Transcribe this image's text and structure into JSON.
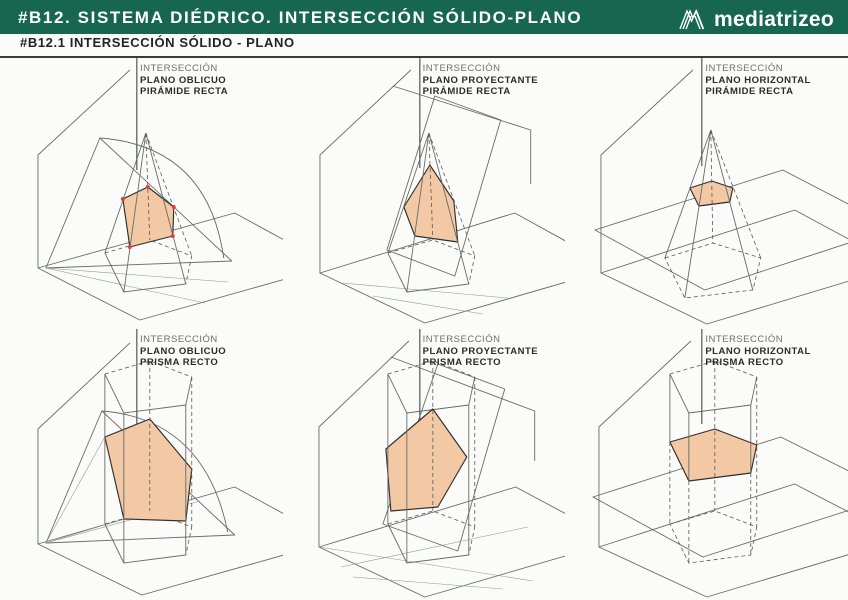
{
  "header": {
    "title": "#B12. SISTEMA DIÉDRICO. INTERSECCIÓN SÓLIDO-PLANO",
    "brand": "mediatrizeo"
  },
  "subheader": {
    "title": "#B12.1 INTERSECCIÓN SÓLIDO - PLANO"
  },
  "colors": {
    "header_green": "#17664f",
    "rule_dark": "#3a3a3a",
    "section_fill": "#f3c8a4",
    "section_outline": "#2f2f2f",
    "dot_red": "#e04040",
    "line_gray": "#676c68",
    "label_gray": "#6e6e6e",
    "label_dark": "#2b2b2b"
  },
  "panels": [
    {
      "id": "plano-oblicuo-piramide",
      "label_lines": [
        "INTERSECCIÓN",
        "PLANO OBLICUO",
        "PIRÁMIDE RECTA"
      ]
    },
    {
      "id": "plano-proyectante-piramide",
      "label_lines": [
        "INTERSECCIÓN",
        "PLANO PROYECTANTE",
        "PIRÁMIDE RECTA"
      ]
    },
    {
      "id": "plano-horizontal-piramide",
      "label_lines": [
        "INTERSECCIÓN",
        "PLANO HORIZONTAL",
        "PIRÁMIDE RECTA"
      ]
    },
    {
      "id": "plano-oblicuo-prisma",
      "label_lines": [
        "INTERSECCIÓN",
        "PLANO OBLICUO",
        "PRISMA RECTO"
      ]
    },
    {
      "id": "plano-proyectante-prisma",
      "label_lines": [
        "INTERSECCIÓN",
        "PLANO PROYECTANTE",
        "PRISMA RECTO"
      ]
    },
    {
      "id": "plano-horizontal-prisma",
      "label_lines": [
        "INTERSECCIÓN",
        "PLANO HORIZONTAL",
        "PRISMA RECTO"
      ]
    }
  ]
}
